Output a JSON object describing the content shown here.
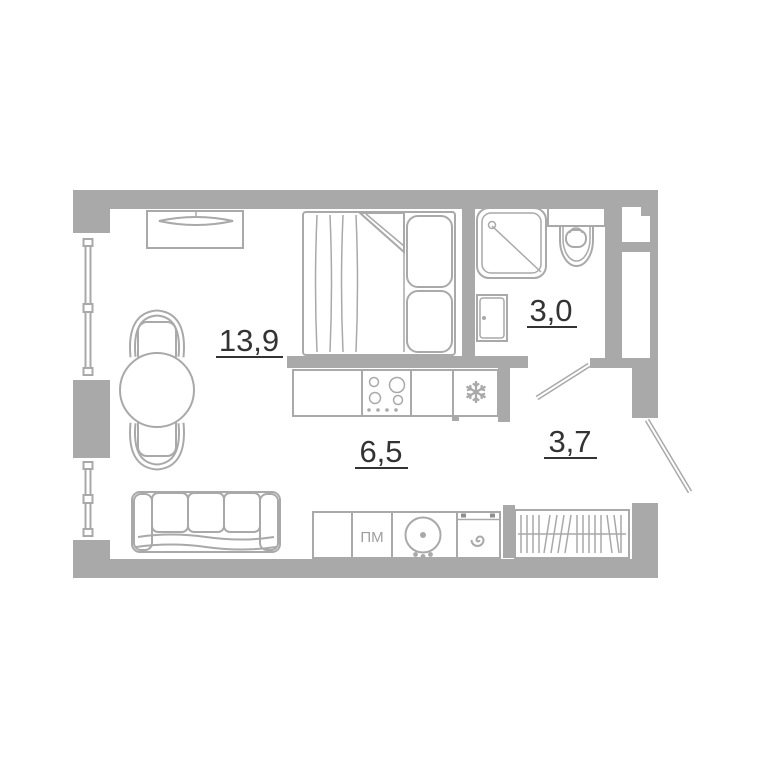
{
  "colors": {
    "wall": "#a9a9a9",
    "line": "#a9a9a9",
    "accent_text": "#333333",
    "fixture_text": "#9e9e9e",
    "control_dark": "#8f8f8f",
    "background": "#ffffff"
  },
  "rooms": {
    "living": {
      "area": "13,9"
    },
    "bathroom": {
      "area": "3,0"
    },
    "kitchen": {
      "area": "6,5"
    },
    "hallway": {
      "area": "3,7"
    }
  },
  "fixtures": {
    "dishwasher_label": "ПМ",
    "fridge_icon": "snowflake-icon",
    "washer_icon": "spiral-icon"
  }
}
